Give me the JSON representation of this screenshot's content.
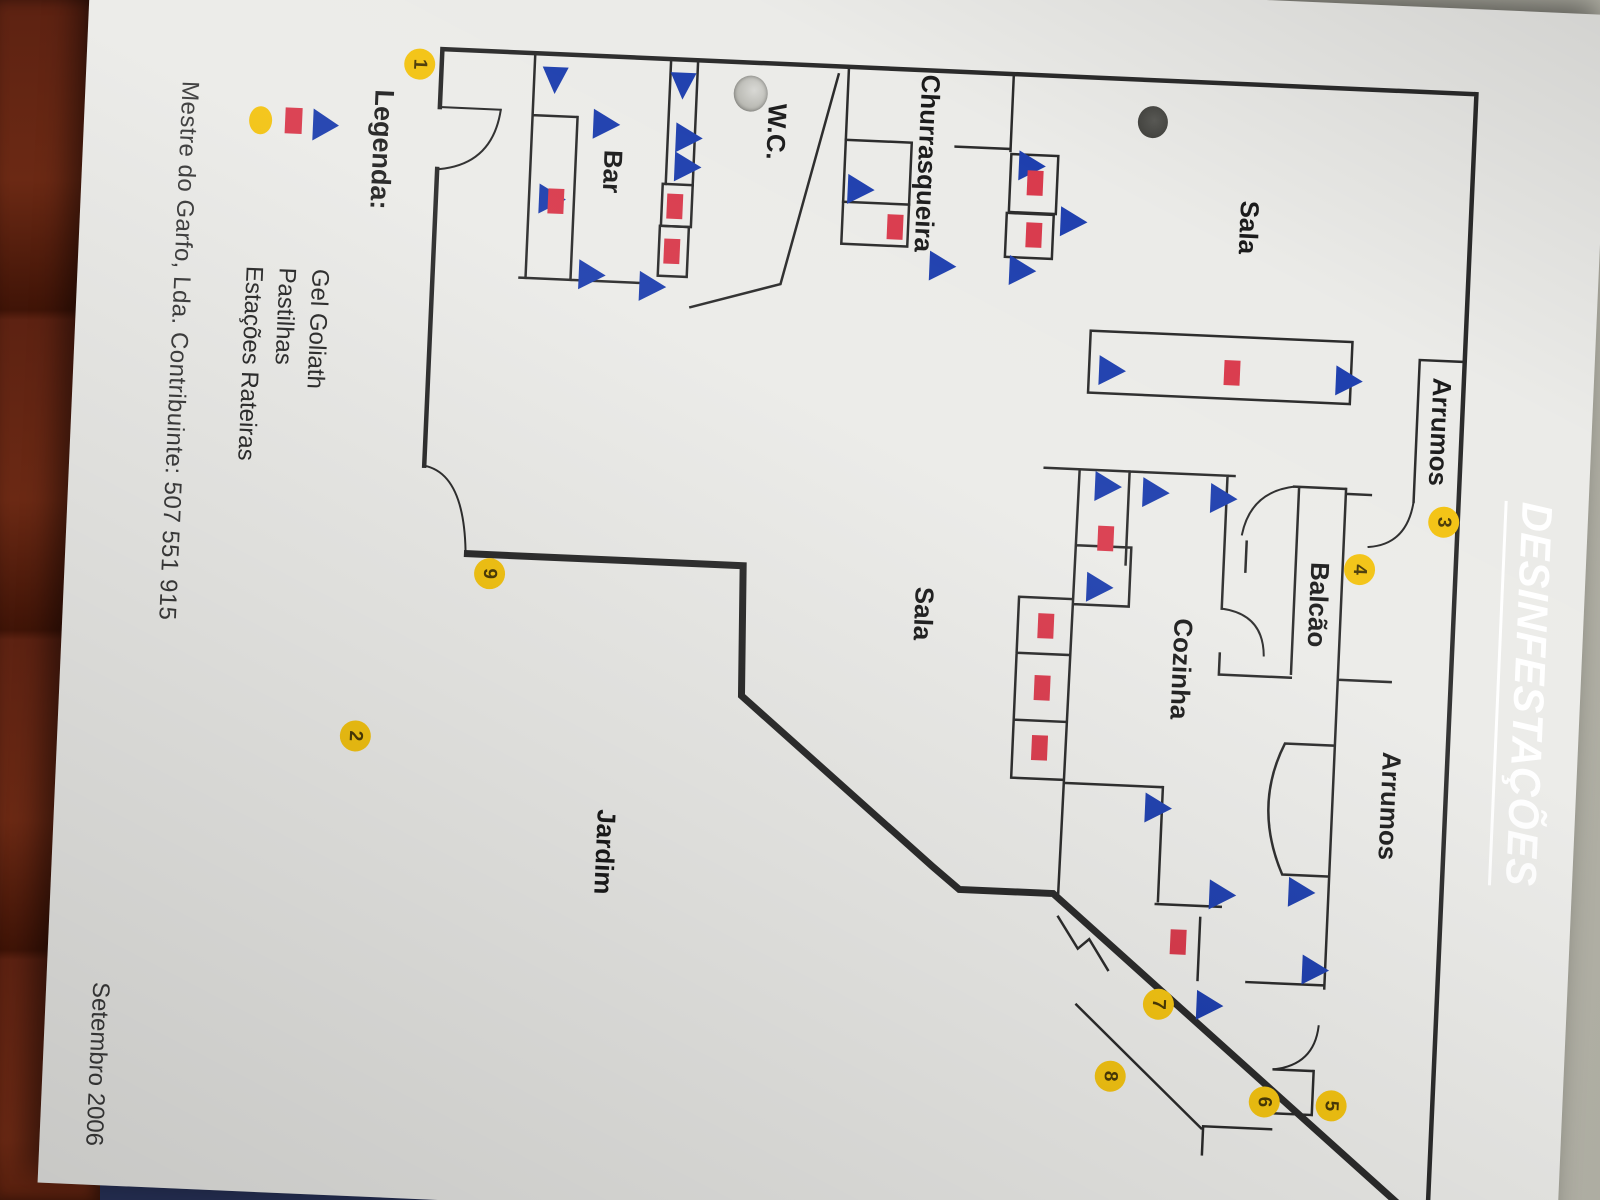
{
  "title": {
    "text": "DESINFESTAÇÕES"
  },
  "legend": {
    "heading": "Legenda:",
    "items": [
      {
        "symbol": "gel-triangle",
        "label": "Gel Goliath"
      },
      {
        "symbol": "pastilha-rect",
        "label": "Pastilhas"
      },
      {
        "symbol": "estacao-circle",
        "label": "Estações Rateiras"
      }
    ]
  },
  "footer": {
    "company": "Mestre do Garfo, Lda. Contribuinte: 507 551 915",
    "date": "Setembro 2006"
  },
  "colors": {
    "banner_blue": "#1d3fa8",
    "gel_blue": "#1e3fae",
    "pastilha_red": "#d93a4c",
    "station_yellow": "#f3c312",
    "wall": "#2b2b2b"
  },
  "rooms": [
    {
      "name": "Sala",
      "x": 228,
      "y": 352
    },
    {
      "name": "Arrumos",
      "x": 424,
      "y": 152
    },
    {
      "name": "Balcão",
      "x": 602,
      "y": 266
    },
    {
      "name": "Cozinha",
      "x": 672,
      "y": 400
    },
    {
      "name": "Arrumos",
      "x": 800,
      "y": 186
    },
    {
      "name": "Sala",
      "x": 628,
      "y": 660
    },
    {
      "name": "Jardim",
      "x": 880,
      "y": 968
    },
    {
      "name": "Churrasqueira",
      "x": 178,
      "y": 676
    },
    {
      "name": "W.C.",
      "x": 153,
      "y": 828
    },
    {
      "name": "Bar",
      "x": 200,
      "y": 990
    }
  ],
  "markers": {
    "gel_triangles": [
      {
        "x": 98,
        "y": 1051,
        "dir": "right"
      },
      {
        "x": 98,
        "y": 923,
        "dir": "right"
      },
      {
        "x": 153,
        "y": 1011,
        "dir": "up"
      },
      {
        "x": 230,
        "y": 1062,
        "dir": "up"
      },
      {
        "x": 304,
        "y": 1019,
        "dir": "up"
      },
      {
        "x": 313,
        "y": 958,
        "dir": "up"
      },
      {
        "x": 163,
        "y": 928,
        "dir": "up"
      },
      {
        "x": 192,
        "y": 928,
        "dir": "up"
      },
      {
        "x": 207,
        "y": 754,
        "dir": "up"
      },
      {
        "x": 280,
        "y": 669,
        "dir": "up"
      },
      {
        "x": 176,
        "y": 584,
        "dir": "up"
      },
      {
        "x": 281,
        "y": 589,
        "dir": "up"
      },
      {
        "x": 230,
        "y": 540,
        "dir": "up"
      },
      {
        "x": 377,
        "y": 258,
        "dir": "up"
      },
      {
        "x": 377,
        "y": 495,
        "dir": "up"
      },
      {
        "x": 493,
        "y": 494,
        "dir": "up"
      },
      {
        "x": 497,
        "y": 446,
        "dir": "up"
      },
      {
        "x": 500,
        "y": 378,
        "dir": "up"
      },
      {
        "x": 594,
        "y": 498,
        "dir": "up"
      },
      {
        "x": 812,
        "y": 430,
        "dir": "up"
      },
      {
        "x": 896,
        "y": 362,
        "dir": "up"
      },
      {
        "x": 890,
        "y": 283,
        "dir": "up"
      },
      {
        "x": 967,
        "y": 266,
        "dir": "up"
      },
      {
        "x": 1007,
        "y": 370,
        "dir": "up"
      }
    ],
    "pastilhas": [
      {
        "x": 232,
        "y": 1045
      },
      {
        "x": 232,
        "y": 926
      },
      {
        "x": 277,
        "y": 927
      },
      {
        "x": 193,
        "y": 567
      },
      {
        "x": 245,
        "y": 566
      },
      {
        "x": 243,
        "y": 705
      },
      {
        "x": 374,
        "y": 362
      },
      {
        "x": 545,
        "y": 481
      },
      {
        "x": 635,
        "y": 537
      },
      {
        "x": 697,
        "y": 538
      },
      {
        "x": 757,
        "y": 538
      },
      {
        "x": 945,
        "y": 391
      }
    ],
    "stations": [
      {
        "n": "1",
        "x": 101,
        "y": 1187
      },
      {
        "n": "2",
        "x": 775,
        "y": 1222
      },
      {
        "n": "3",
        "x": 514,
        "y": 144
      },
      {
        "n": "4",
        "x": 565,
        "y": 226
      },
      {
        "n": "5",
        "x": 1102,
        "y": 231
      },
      {
        "n": "6",
        "x": 1101,
        "y": 298
      },
      {
        "n": "7",
        "x": 1008,
        "y": 408
      },
      {
        "n": "8",
        "x": 1082,
        "y": 453
      },
      {
        "n": "9",
        "x": 607,
        "y": 1095
      }
    ]
  }
}
